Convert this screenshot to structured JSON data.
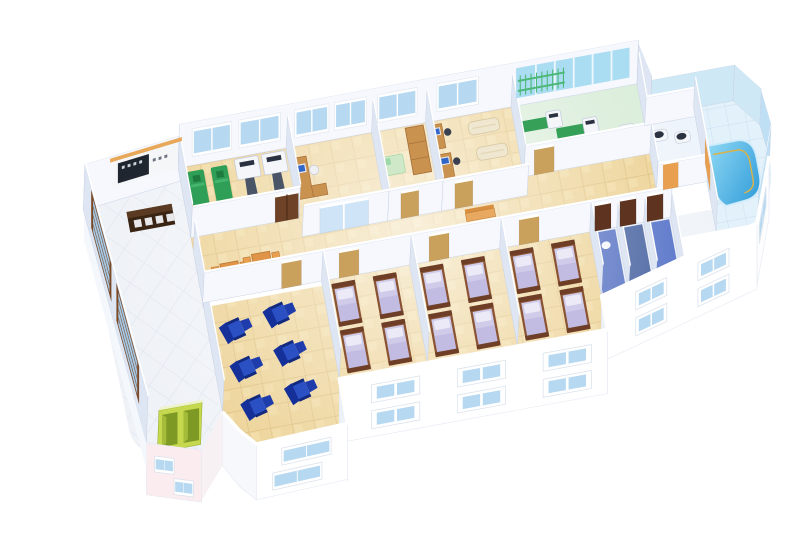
{
  "meta": {
    "description": "3D isometric cutaway rendering of a hospital / rehabilitation clinic floor plan",
    "view": "isometric-cutaway",
    "visible_text": []
  },
  "palette": {
    "background": "#ffffff",
    "floor_tan": "#ecd193",
    "floor_tan_line": "#d9b873",
    "floor_white": "#eff2f7",
    "floor_white_line": "#dde3ee",
    "floor_green": "#d8ecd8",
    "floor_deck": "#e3f1fa",
    "floor_deck_line": "#c8e0f0",
    "floor_blue1": "#4f6cc0",
    "floor_blue2": "#45609f",
    "floor_blue3": "#5572c8",
    "wall_light": "#f6f8fd",
    "wall_shade": "#dfe6f3",
    "wall_stroke": "#c9d3e6",
    "wall_top": "#ffffff",
    "pool_wall": "#cfe8f6",
    "pool_wall_side": "#bfe0f4",
    "glass": "#b6d8f1",
    "glass_band": "#aadcf2",
    "window_frame": "#ffffff",
    "window_frame_brown": "#7a4a28",
    "glass_brown_window": "#a4c8e6",
    "pool_water_light": "#8fd8f4",
    "pool_water_deep": "#2e9ad8",
    "rail": "#d9b24a",
    "wood_dark": "#6e4226",
    "wood": "#c9924f",
    "door_tan": "#c9a05c",
    "door_dark": "#5e3420",
    "door_orange": "#e8a050",
    "bed_frame": "#8a5434",
    "bedding": "#cfcbe9",
    "pillow": "#eceaf6",
    "green_bed": "#2f9e57",
    "green_bed_dark": "#1f7a40",
    "machine_white": "#f4f6fa",
    "machine_gray": "#4a5568",
    "machine_slot": "#2a3140",
    "recliner_dark": "#16309a",
    "recliner": "#2a50c4",
    "recliner_deep": "#1e3cab",
    "orange_table": "#e09448",
    "orange_chair": "#e8a050",
    "bench_orange": "#e8a860",
    "cream": "#efe7cf",
    "monitor_blue": "#2f66c8",
    "elevator_green": "#c6d84e",
    "elevator_dark": "#7e9a24",
    "pink_wall": "#fbecef",
    "sign_dark": "#20262f",
    "sign_beam": "#e8a85a",
    "pt_mat_green": "#36a058",
    "wall_bars_green": "#4db878"
  },
  "scene": {
    "building": "single floor slab with rounded right end and left lobby wing",
    "rooms": [
      {
        "name": "lobby",
        "floor": "white diamond tile",
        "items": [
          "reception-counter",
          "wall-signboard",
          "tall-brown-frame-windows",
          "green-elevator-doors"
        ]
      },
      {
        "name": "treatment-room",
        "floor": "tan tile",
        "items": [
          "green-treatment-bed x2",
          "traction-machine x2",
          "brown-double-door"
        ]
      },
      {
        "name": "office",
        "floor": "tan tile",
        "items": [
          "wood-desk",
          "computer-monitor",
          "chair",
          "sliding-glass-door"
        ]
      },
      {
        "name": "storage-room",
        "floor": "tan tile",
        "items": [
          "wardrobe-cabinet",
          "green-mat"
        ]
      },
      {
        "name": "consulting-room",
        "floor": "tan tile",
        "items": [
          "desk-with-computer x2",
          "exam-couch x2"
        ]
      },
      {
        "name": "rehab-gym",
        "floor": "pale green",
        "items": [
          "exercise-machine x3",
          "green-mat x3",
          "wall-bars",
          "window-band"
        ]
      },
      {
        "name": "bathroom",
        "floor": "white",
        "items": [
          "toilet-fixture x2",
          "orange-door"
        ]
      },
      {
        "name": "hydrotherapy-pool-room",
        "floor": "pale blue deck",
        "items": [
          "curved-pool",
          "hand-rail",
          "steps"
        ]
      },
      {
        "name": "corridor",
        "floor": "tan tile",
        "items": [
          "orange-waiting-table-set x2",
          "wood-bench x2",
          "ward-doors"
        ]
      },
      {
        "name": "infusion-lounge",
        "floor": "tan tile",
        "items": [
          "blue-recliner x6"
        ],
        "shape": "rounded outer corner"
      },
      {
        "name": "ward-room-1",
        "floor": "tan tile",
        "items": [
          "bed x4"
        ]
      },
      {
        "name": "ward-room-2",
        "floor": "tan tile",
        "items": [
          "bed x4"
        ]
      },
      {
        "name": "ward-room-3",
        "floor": "tan tile",
        "items": [
          "bed x4"
        ]
      },
      {
        "name": "shower-rooms",
        "floor": "blue tile",
        "items": [
          "stall x3",
          "dark-doors x3",
          "toilet"
        ]
      }
    ],
    "exterior": [
      "white facade",
      "two rows of blue windows",
      "pink tinted wall at lobby base",
      "curved right corner below pool"
    ]
  }
}
